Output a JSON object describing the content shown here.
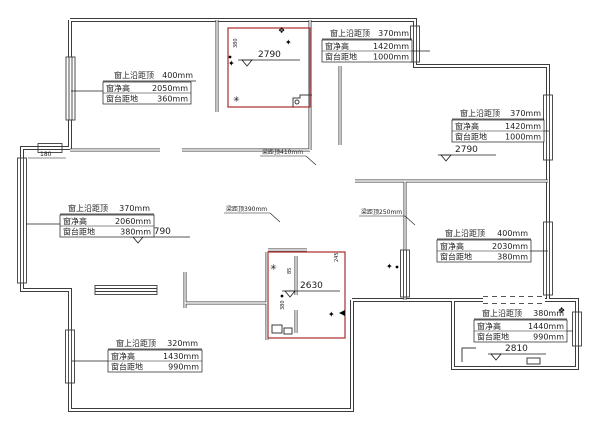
{
  "drawing_title": "户型尺寸测量图",
  "colors": {
    "wall": "#3c3c3c",
    "red_zone": "#b23b3b",
    "text": "#1c1c1c"
  },
  "row_labels": [
    "窗上沿距顶",
    "窗净高",
    "窗台距地"
  ],
  "window_labels": {
    "top_left": {
      "v1": "400mm",
      "v2": "2050mm",
      "v3": "360mm"
    },
    "top_right": {
      "v1": "370mm",
      "v2": "1420mm",
      "v3": "1000mm"
    },
    "right_upper": {
      "v1": "370mm",
      "v2": "1420mm",
      "v3": "1000mm"
    },
    "mid_left": {
      "v1": "370mm",
      "v2": "2060mm",
      "v3": "380mm"
    },
    "right_mid": {
      "v1": "400mm",
      "v2": "2030mm",
      "v3": "380mm"
    },
    "bottom_right": {
      "v1": "380mm",
      "v2": "1440mm",
      "v3": "990mm"
    },
    "bottom_left": {
      "v1": "320mm",
      "v2": "1430mm",
      "v3": "990mm"
    }
  },
  "levels": {
    "top_room": "2790",
    "right_room": "2790",
    "left_room": "2790",
    "center_room": "2630",
    "bottom_right_room": "2810"
  },
  "beams": {
    "b1": "梁距顶410mm",
    "b2": "梁距顶390mm",
    "b3": "梁距顶250mm"
  },
  "dims": {
    "wall_offset": "180",
    "micro_a": "380",
    "micro_b": "85",
    "micro_c": "245",
    "micro_d": "380"
  },
  "symbols": {
    "s_diamond": "✦",
    "s_flower": "❖",
    "s_star": "✳"
  }
}
